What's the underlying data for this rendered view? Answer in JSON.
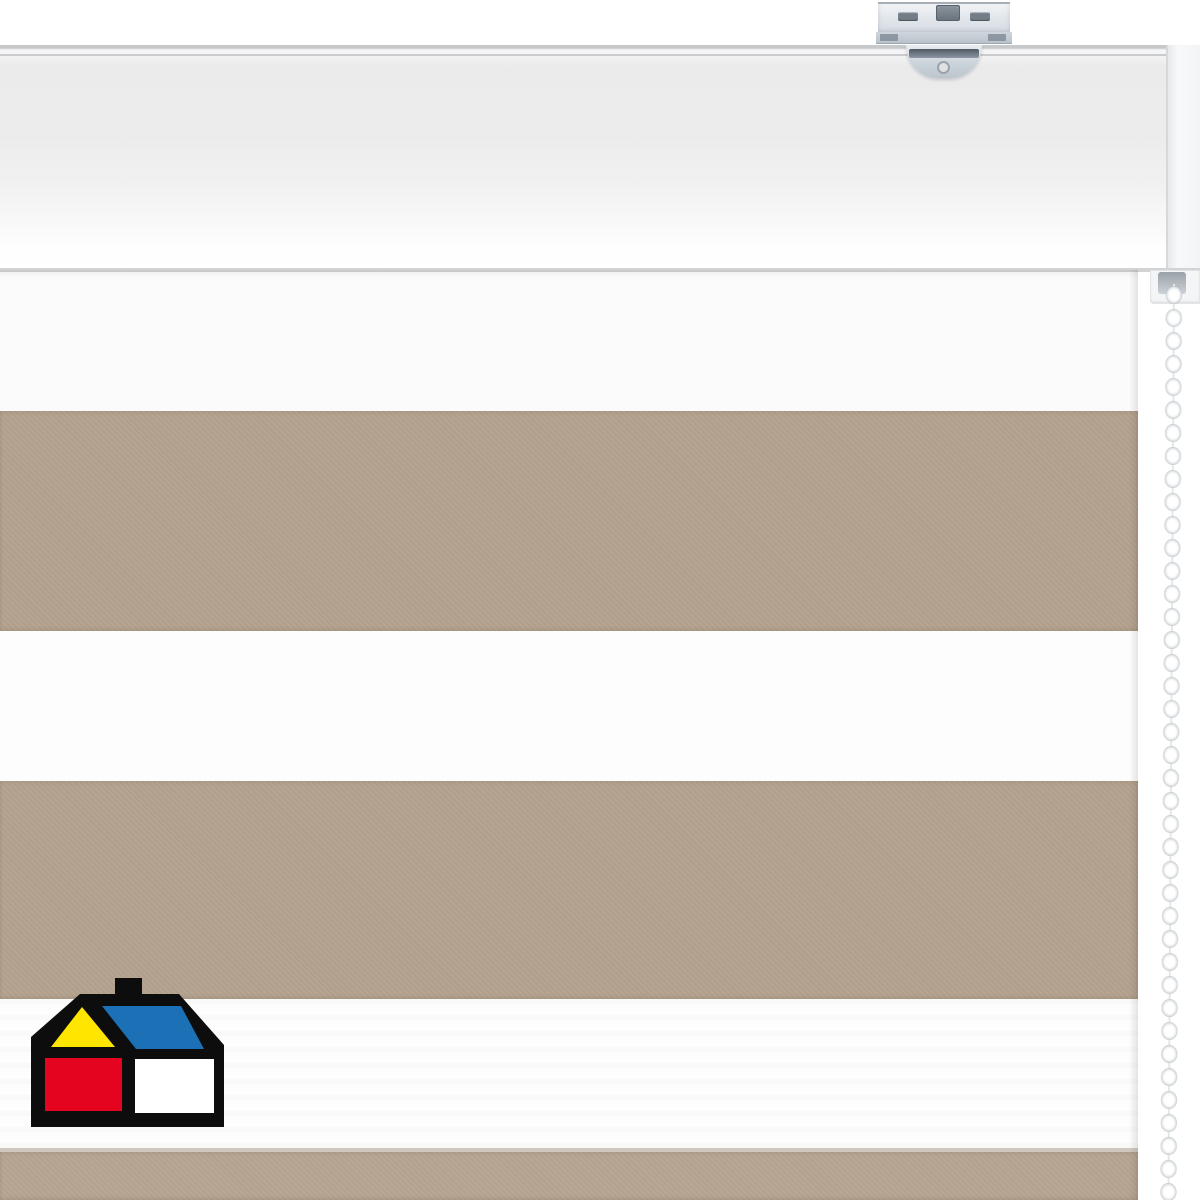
{
  "meta": {
    "description": "Product photograph of a white/taupe day-night (zebra) roller blind: white headrail with metal wall bracket, striped dual fabric, white bead pull-chain on the right, retailer house logo in the lower-left corner",
    "canvas": {
      "width": 1200,
      "height": 1200
    }
  },
  "palette": {
    "background": "#ffffff",
    "white_fabric": "#fcfcfc",
    "taupe": "#b3a18d",
    "taupe_light": "#b6a490",
    "hem_line": "#cfc8bf",
    "rail_edge": "#c6c8ca",
    "metal": "#dce1e7",
    "metal_dark": "#5d6872",
    "chain_bead": "#ffffff",
    "logo_black": "#0d0d0d",
    "logo_yellow": "#ffe600",
    "logo_blue": "#1c70b6",
    "logo_red": "#e40420"
  },
  "headrail": {
    "top": 45,
    "height": 227
  },
  "bracket": {
    "x": 878,
    "plate_width": 132
  },
  "chain": {
    "x": 1161,
    "top": 284,
    "bead_pitch": 23,
    "bead_count": 40
  },
  "chain_housing": {
    "x": 1150,
    "y": 270
  },
  "fabric": {
    "left": 0,
    "right": 1138,
    "top": 270,
    "stripes": [
      {
        "name": "white-band-top",
        "top": 270,
        "height": 141,
        "color": "#fbfbfb",
        "texture": false,
        "sheen": false
      },
      {
        "name": "taupe-band-1",
        "top": 411,
        "height": 220,
        "color": "#b3a18d",
        "texture": true,
        "sheen": false
      },
      {
        "name": "white-band-middle",
        "top": 631,
        "height": 150,
        "color": "#fdfdfd",
        "texture": false,
        "sheen": false
      },
      {
        "name": "taupe-band-2",
        "top": 781,
        "height": 218,
        "color": "#b3a18d",
        "texture": true,
        "sheen": false
      },
      {
        "name": "white-band-bottom",
        "top": 999,
        "height": 149,
        "color": "#fdfdfd",
        "texture": false,
        "sheen": true
      },
      {
        "name": "hem-line",
        "top": 1148,
        "height": 4,
        "color": "#cfc8bf",
        "texture": false,
        "sheen": false
      },
      {
        "name": "taupe-band-bottom",
        "top": 1152,
        "height": 48,
        "color": "#b6a490",
        "texture": true,
        "sheen": false
      }
    ]
  },
  "logo": {
    "name": "homecenter-house-logo",
    "x": 30,
    "y": 977,
    "width": 196,
    "height": 151
  }
}
